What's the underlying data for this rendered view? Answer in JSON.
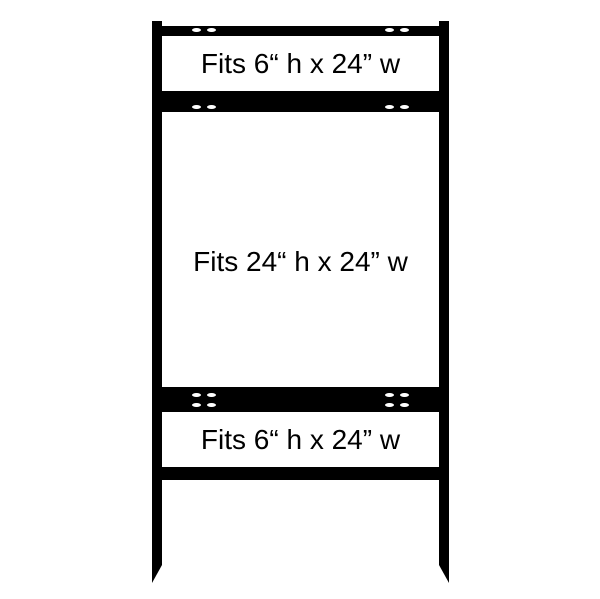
{
  "colors": {
    "frame": "#000000",
    "panel": "#ffffff",
    "label_text": "#000000"
  },
  "panels": [
    {
      "label": "Fits 6“ h x 24” w"
    },
    {
      "label": "Fits 24“ h x 24” w"
    },
    {
      "label": "Fits 6“ h x 24” w"
    }
  ]
}
